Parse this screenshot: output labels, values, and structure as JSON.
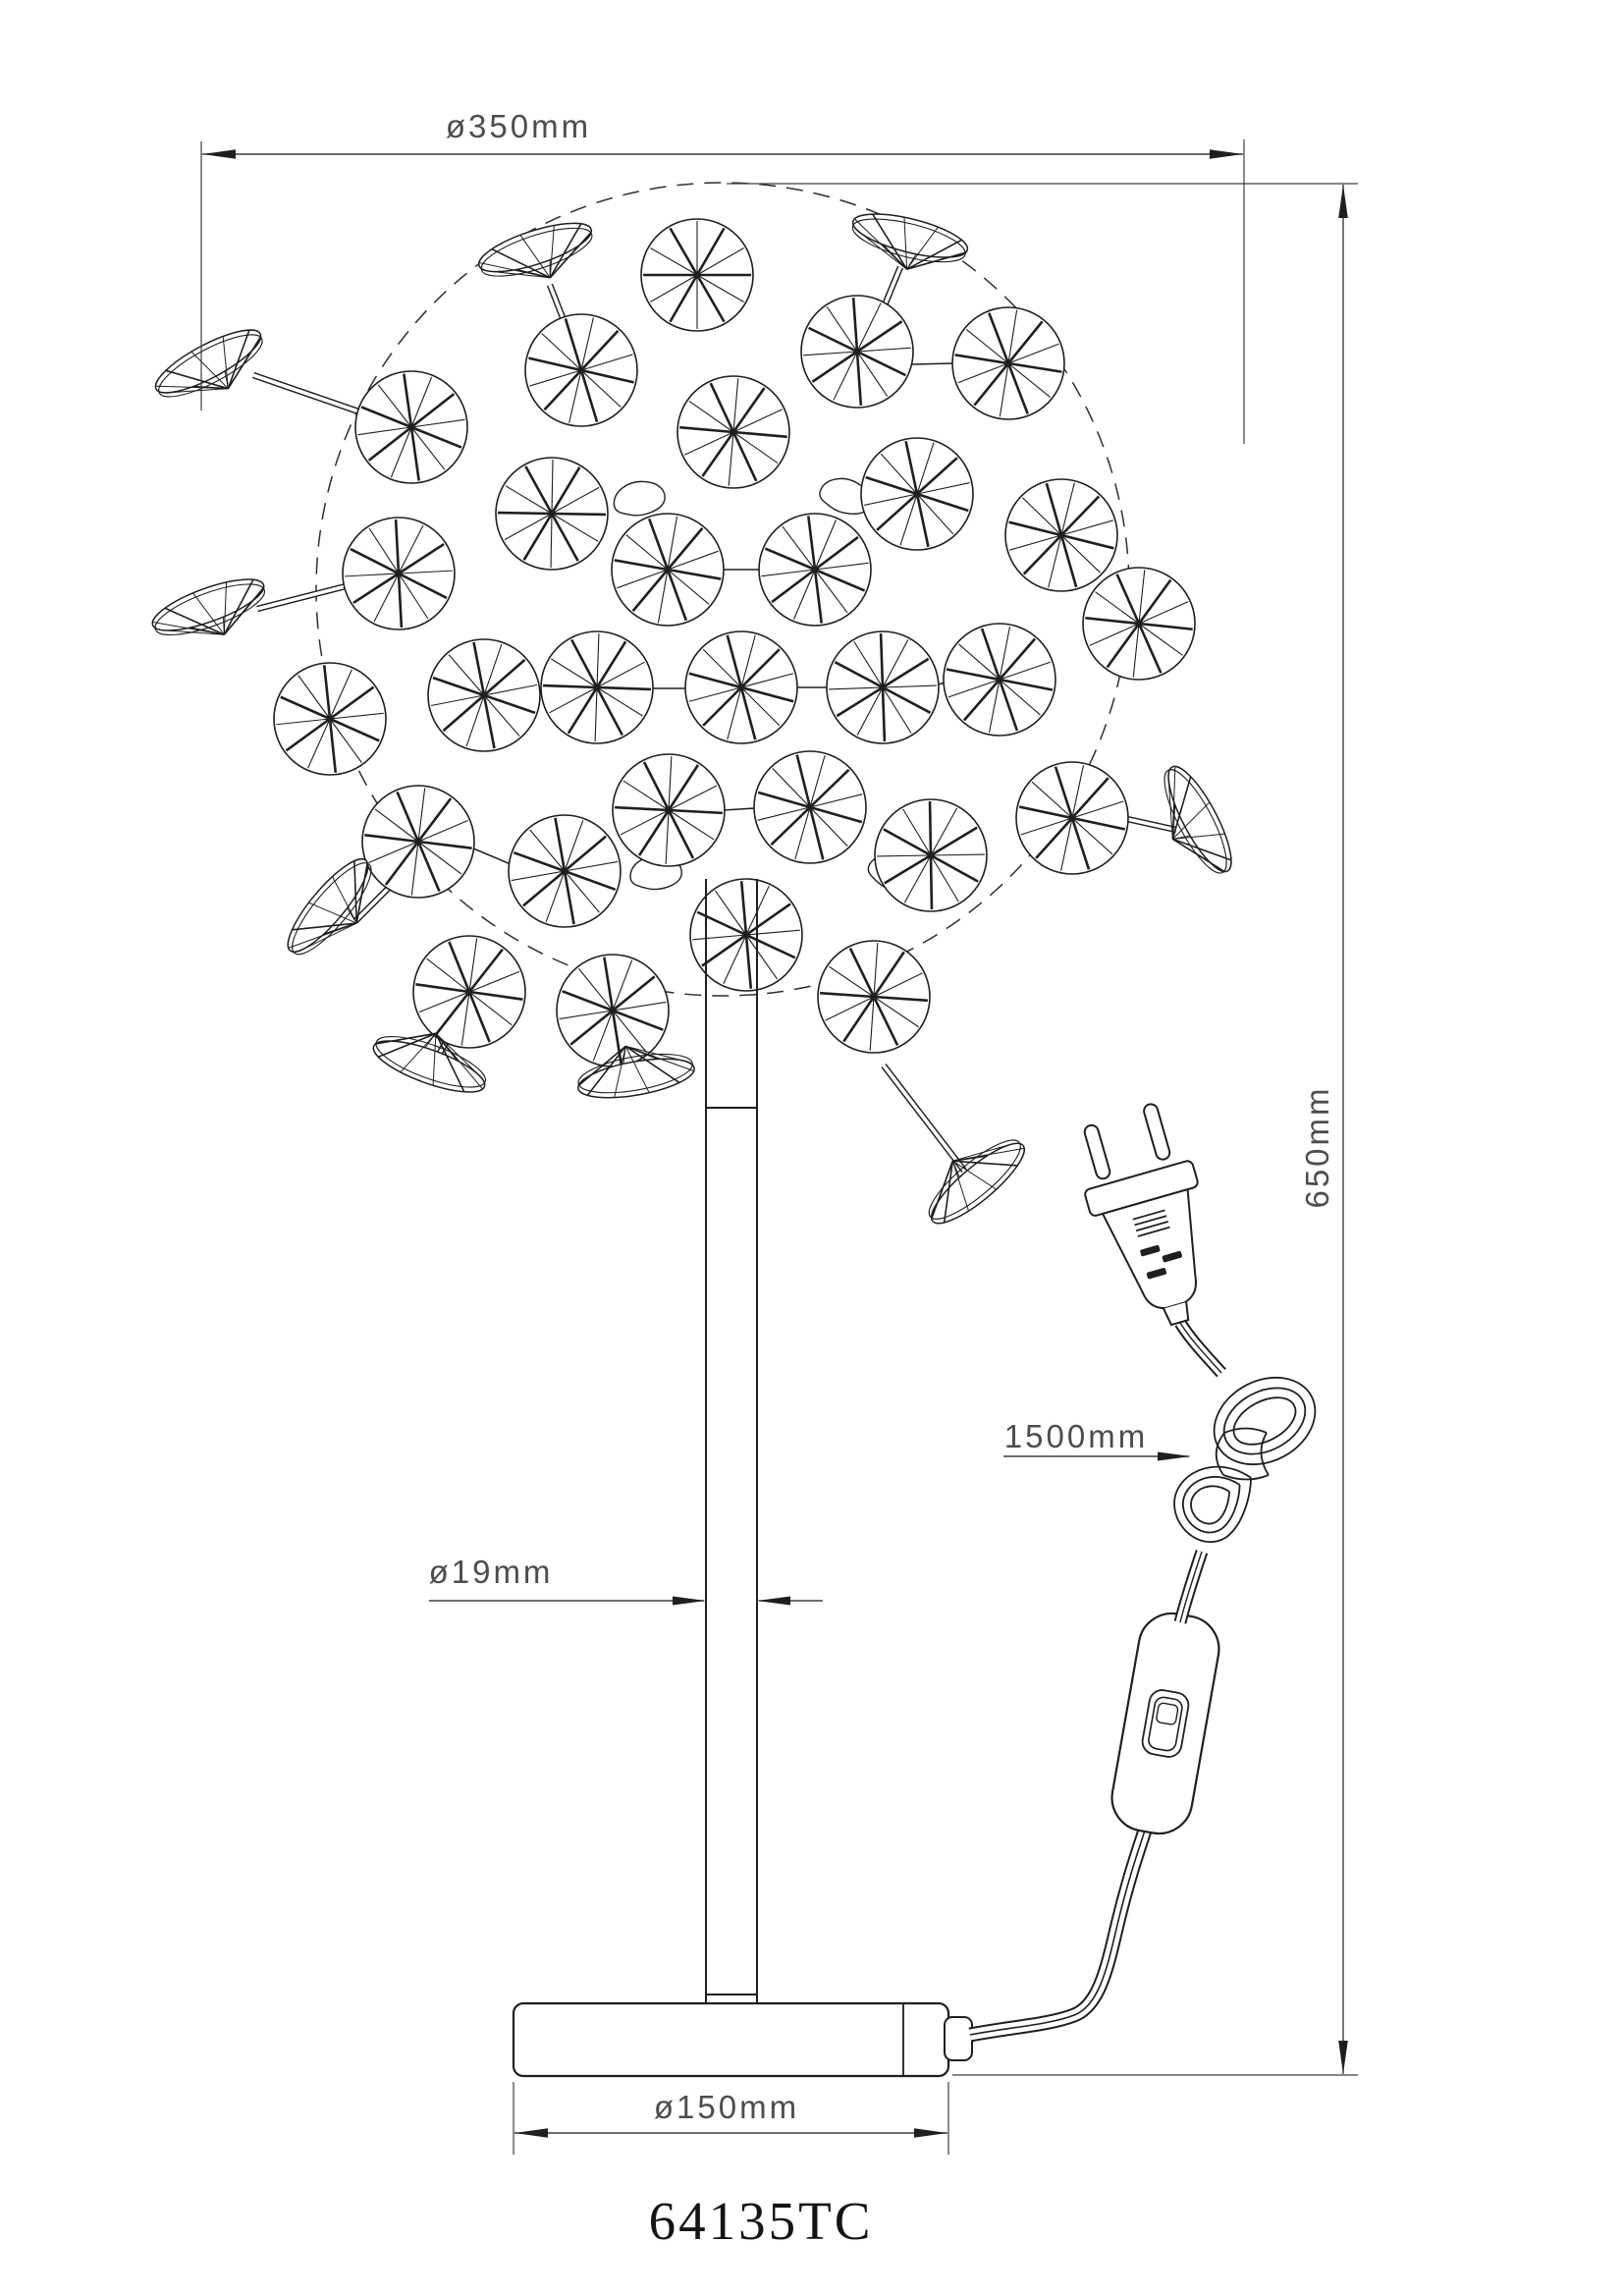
{
  "drawing": {
    "model_code": "64135TC",
    "dimension_labels": {
      "head_diameter": "ø350mm",
      "overall_height": "650mm",
      "pole_diameter": "ø19mm",
      "cord_length": "1500mm",
      "base_diameter": "ø150mm"
    },
    "colors": {
      "background": "#ffffff",
      "object_line": "#1f1f1f",
      "dimension_line": "#3f3f3f",
      "text": "#4d4d4d"
    }
  }
}
